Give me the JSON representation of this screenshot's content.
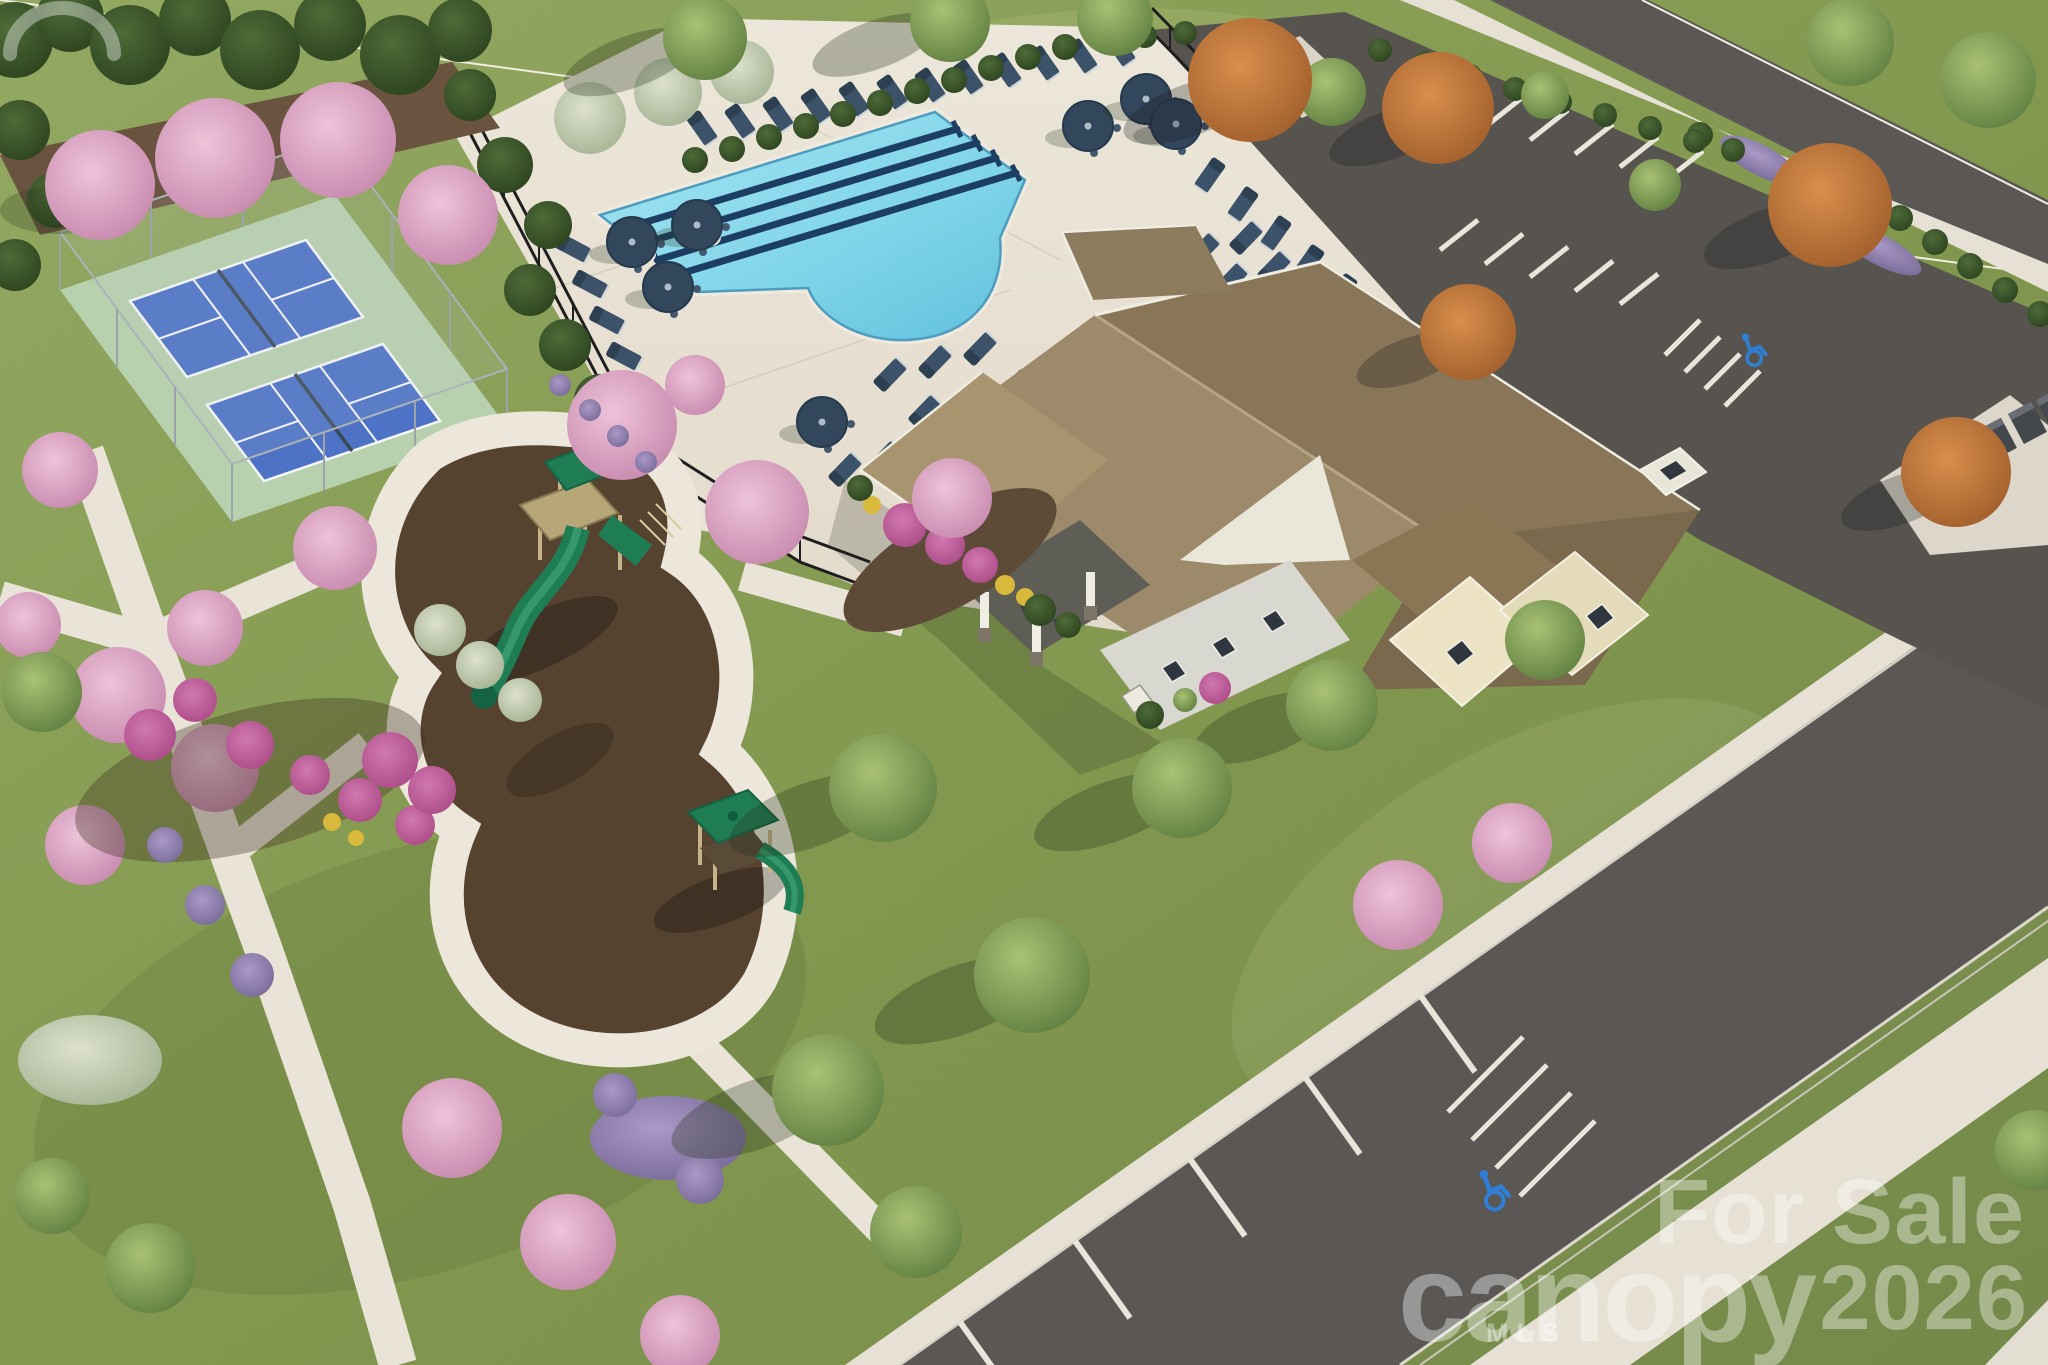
{
  "image": {
    "type": "aerial-3d-architectural-rendering",
    "subject": "Community amenity center: clubhouse with pool, pickleball courts, playground, parking and street"
  },
  "watermarks": {
    "sale_line1": "For Sale",
    "sale_line2": "2026",
    "brand": "canopy",
    "brand_sub": "MLS"
  },
  "scene": {
    "amenities": [
      "clubhouse with brown shingle roof and covered porch",
      "swimming pool with lap lanes and free-form end",
      "pool deck with navy loungers and umbrellas",
      "two blue pickleball courts on green sport pad",
      "playground with two green play structures on mulch",
      "parking lot with landscaped islands and cluster mailboxes",
      "walking paths and street with marked stalls"
    ],
    "pool_lap_lanes": 4,
    "pickleball_courts": 2,
    "play_structures": 2,
    "parking_features": [
      "accessible stall markings",
      "hatched no-parking zone",
      "cluster mailboxes"
    ]
  },
  "icons": {
    "handicap_icon": "wheelchair accessible parking symbol",
    "canopy_arc_icon": "arc over the n of canopy logo"
  },
  "palette": {
    "lawn": "#83995175",
    "lawn_light": "#90a55e",
    "pool_water": "#7fd4e8",
    "lane_line": "#1d3e63",
    "deck_concrete": "#eae5d8",
    "court_blue": "#4d72c6",
    "court_pad_green": "#b7d0ae",
    "playground_mulch": "#55422f",
    "roof_brown": "#8d7b5e",
    "asphalt": "#57544f",
    "sidewalk": "#e8e3d6",
    "pink_tree": "#d6a0bf",
    "orange_tree": "#c07a3e",
    "evergreen": "#3c5429",
    "navy_furniture": "#3c5268",
    "handicap_blue": "#2f7fd6",
    "watermark": "rgba(255,255,255,0.38)"
  }
}
